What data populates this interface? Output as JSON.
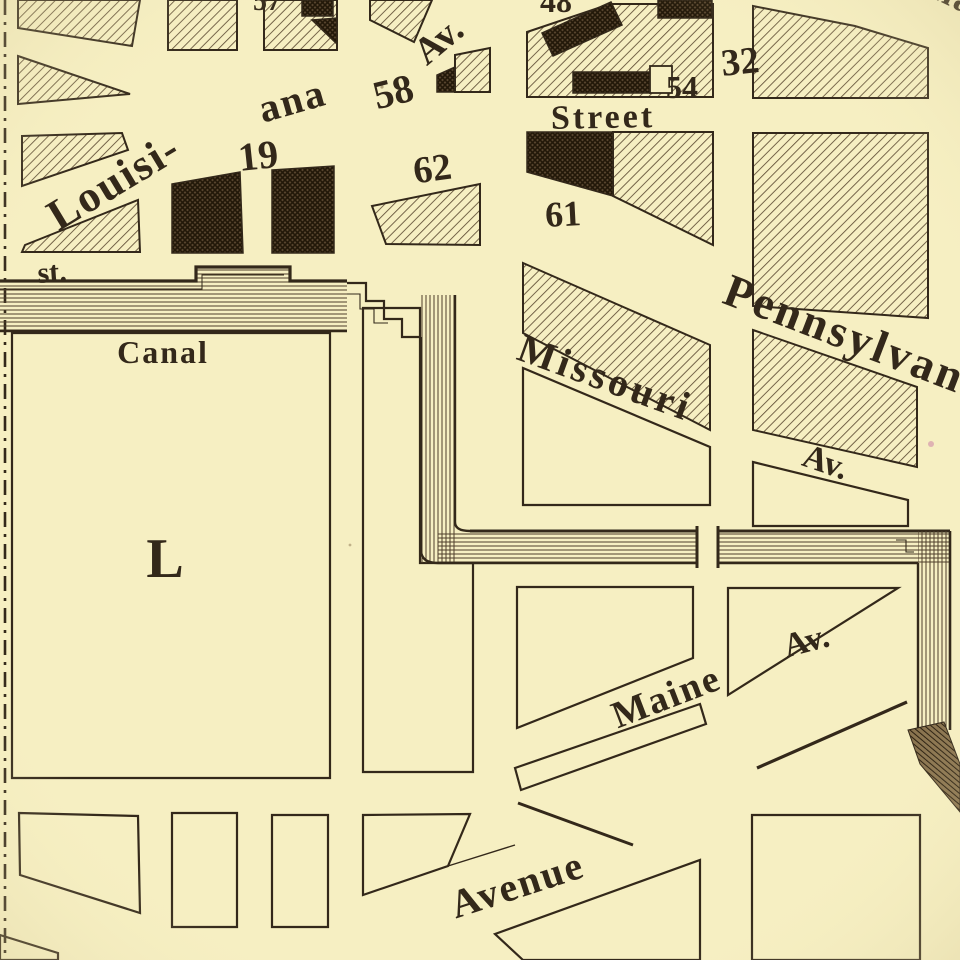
{
  "map": {
    "labels": {
      "louisiana_line1": "Louisi-",
      "louisiana_line2": "ana",
      "louisiana_av": "Av.",
      "street": "Street",
      "indiana": "Indiana",
      "pennsylvania": "Pennsylvan",
      "missouri": "Missouri",
      "missouri_av": "Av.",
      "canal": "Canal",
      "st_abbrev": "st.",
      "square_letter": "L",
      "maine": "Maine",
      "maine_av": "Av.",
      "avenue": "Avenue"
    },
    "square_numbers": {
      "n19": "19",
      "n32": "32",
      "n48": "48",
      "n54": "54",
      "n57": "57",
      "n58": "58",
      "n61": "61",
      "n62": "62"
    },
    "colors": {
      "paper": "#f6efc2",
      "ink": "#33281a",
      "hatch": "#5d4b33",
      "dark_block": "#57452e",
      "canal_line": "#4e3e2a",
      "blemish_pink": "#d79fae"
    }
  }
}
